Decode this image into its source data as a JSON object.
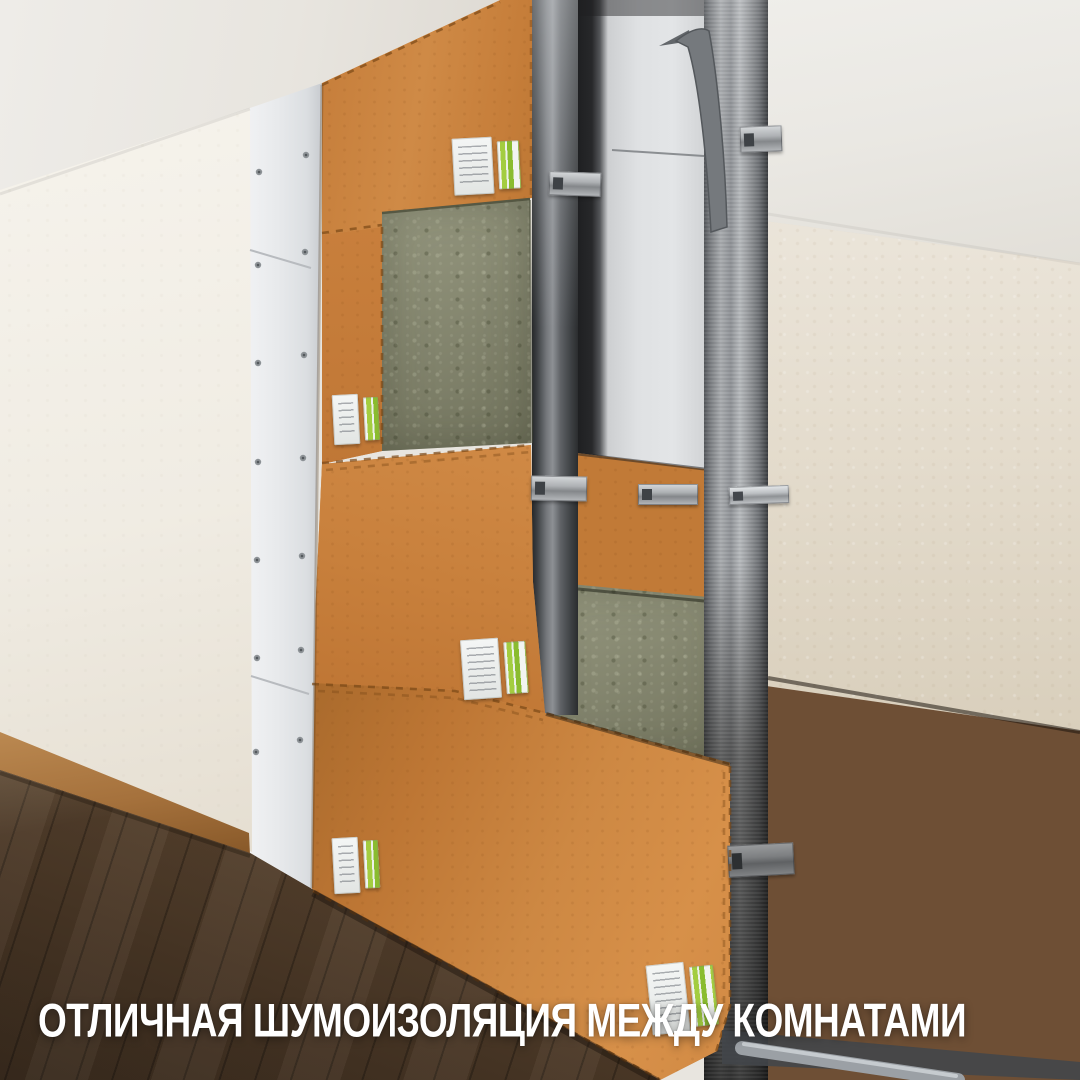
{
  "caption": {
    "text": "ОТЛИЧНАЯ ШУМОИЗОЛЯЦИЯ МЕЖДУ КОМНАТАМИ"
  },
  "scene": {
    "type": "3d-render-photo",
    "subject": "cutaway of a soundproof partition wall between two rooms",
    "components": [
      "finish-drywall-layer",
      "soundproof-panel-layer",
      "mineral-wool-layer",
      "steel-stud-frame",
      "connection-brackets",
      "product-labels",
      "wood-floor",
      "room-walls"
    ],
    "product_label_count": 5
  },
  "palette": {
    "panel_orange": "#c9813e",
    "mineral_wool_green": "#8b8d72",
    "steel_light": "#a7aaad",
    "steel_dark": "#4a4d50",
    "drywall_white": "#e7e9eb",
    "left_wall": "#f2efe8",
    "right_wall": "#e3dbce",
    "floor_near": "#4a3726",
    "floor_far": "#6e4f35",
    "baseboard": "#a5713c",
    "label_green": "#9cc83e",
    "caption_text": "#ffffff"
  }
}
